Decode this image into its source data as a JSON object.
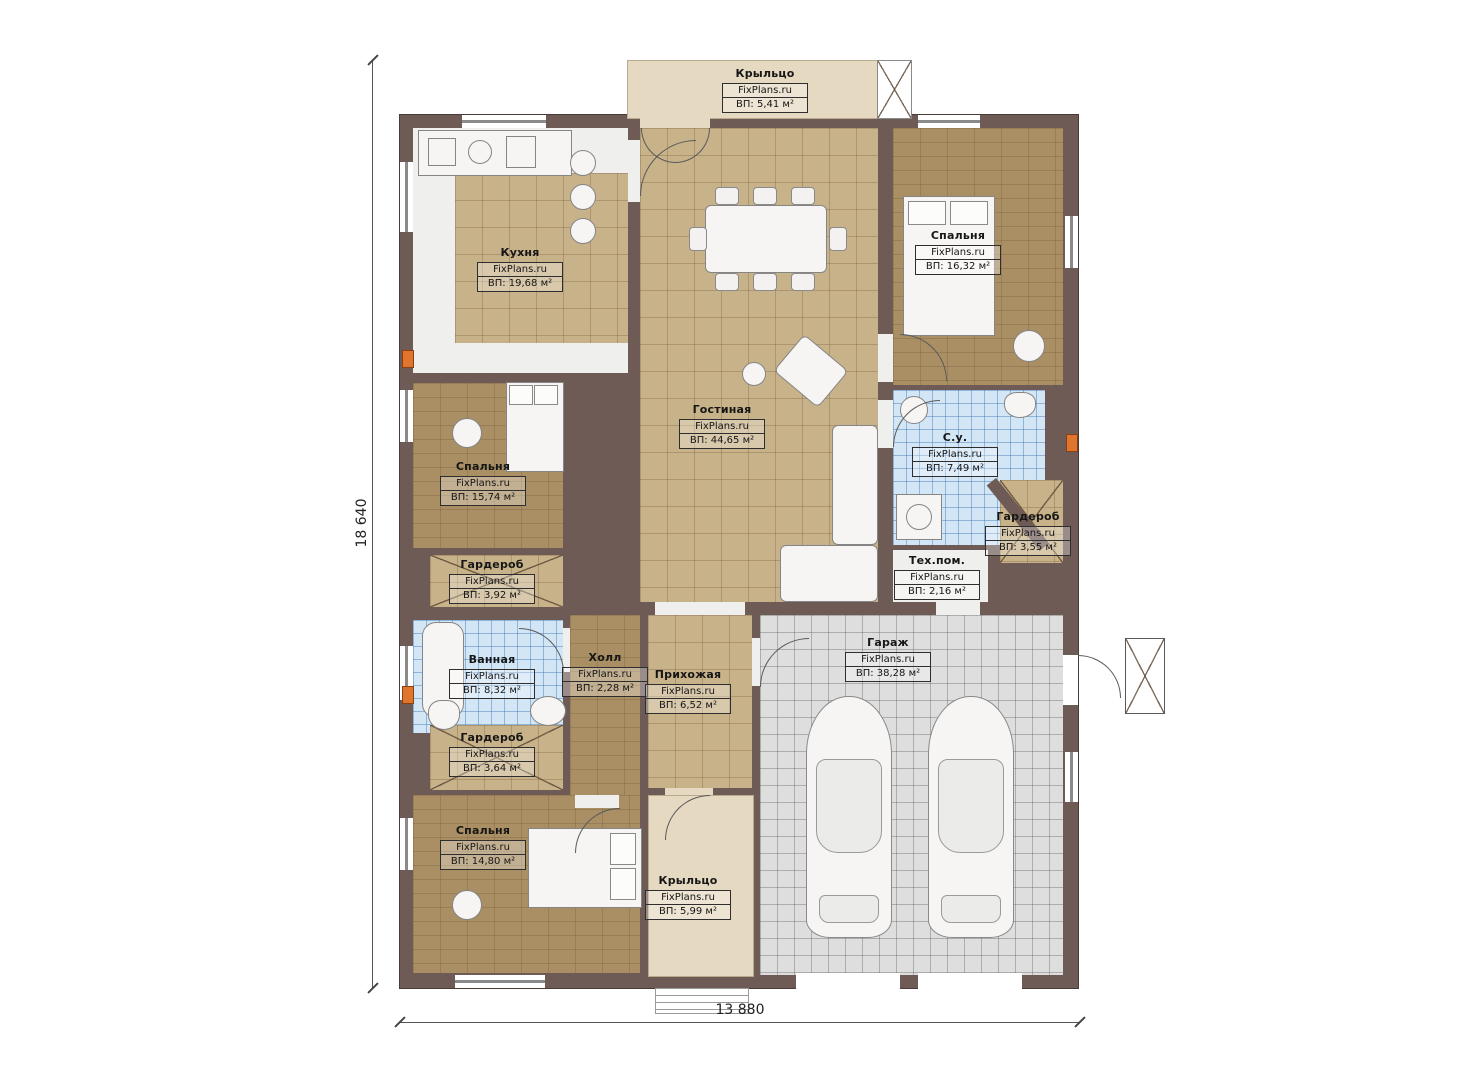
{
  "plan": {
    "site": "FixPlans.ru",
    "dimensions": {
      "width_label": "13 880",
      "height_label": "18 640"
    },
    "colors": {
      "wall": "#6e5b56",
      "tile_tan": "#c8b28a",
      "wood": "#a98f63",
      "tile_blue": "#d3e6f5",
      "tile_gray": "#dedede",
      "porch": "#e6d9c2",
      "marker_orange": "#e0762e"
    },
    "rooms": [
      {
        "name": "Крыльцо",
        "area": "ВП: 5,41 м²"
      },
      {
        "name": "Кухня",
        "area": "ВП: 19,68 м²"
      },
      {
        "name": "Спальня",
        "area": "ВП: 16,32 м²"
      },
      {
        "name": "Гостиная",
        "area": "ВП: 44,65 м²"
      },
      {
        "name": "Спальня",
        "area": "ВП: 15,74 м²"
      },
      {
        "name": "С.у.",
        "area": "ВП: 7,49 м²"
      },
      {
        "name": "Гардероб",
        "area": "ВП: 3,55 м²"
      },
      {
        "name": "Тех.пом.",
        "area": "ВП: 2,16 м²"
      },
      {
        "name": "Гардероб",
        "area": "ВП: 3,92 м²"
      },
      {
        "name": "Ванная",
        "area": "ВП: 8,32 м²"
      },
      {
        "name": "Холл",
        "area": "ВП: 2,28 м²"
      },
      {
        "name": "Прихожая",
        "area": "ВП: 6,52 м²"
      },
      {
        "name": "Гараж",
        "area": "ВП: 38,28 м²"
      },
      {
        "name": "Гардероб",
        "area": "ВП: 3,64 м²"
      },
      {
        "name": "Спальня",
        "area": "ВП: 14,80 м²"
      },
      {
        "name": "Крыльцо",
        "area": "ВП: 5,99 м²"
      }
    ]
  }
}
